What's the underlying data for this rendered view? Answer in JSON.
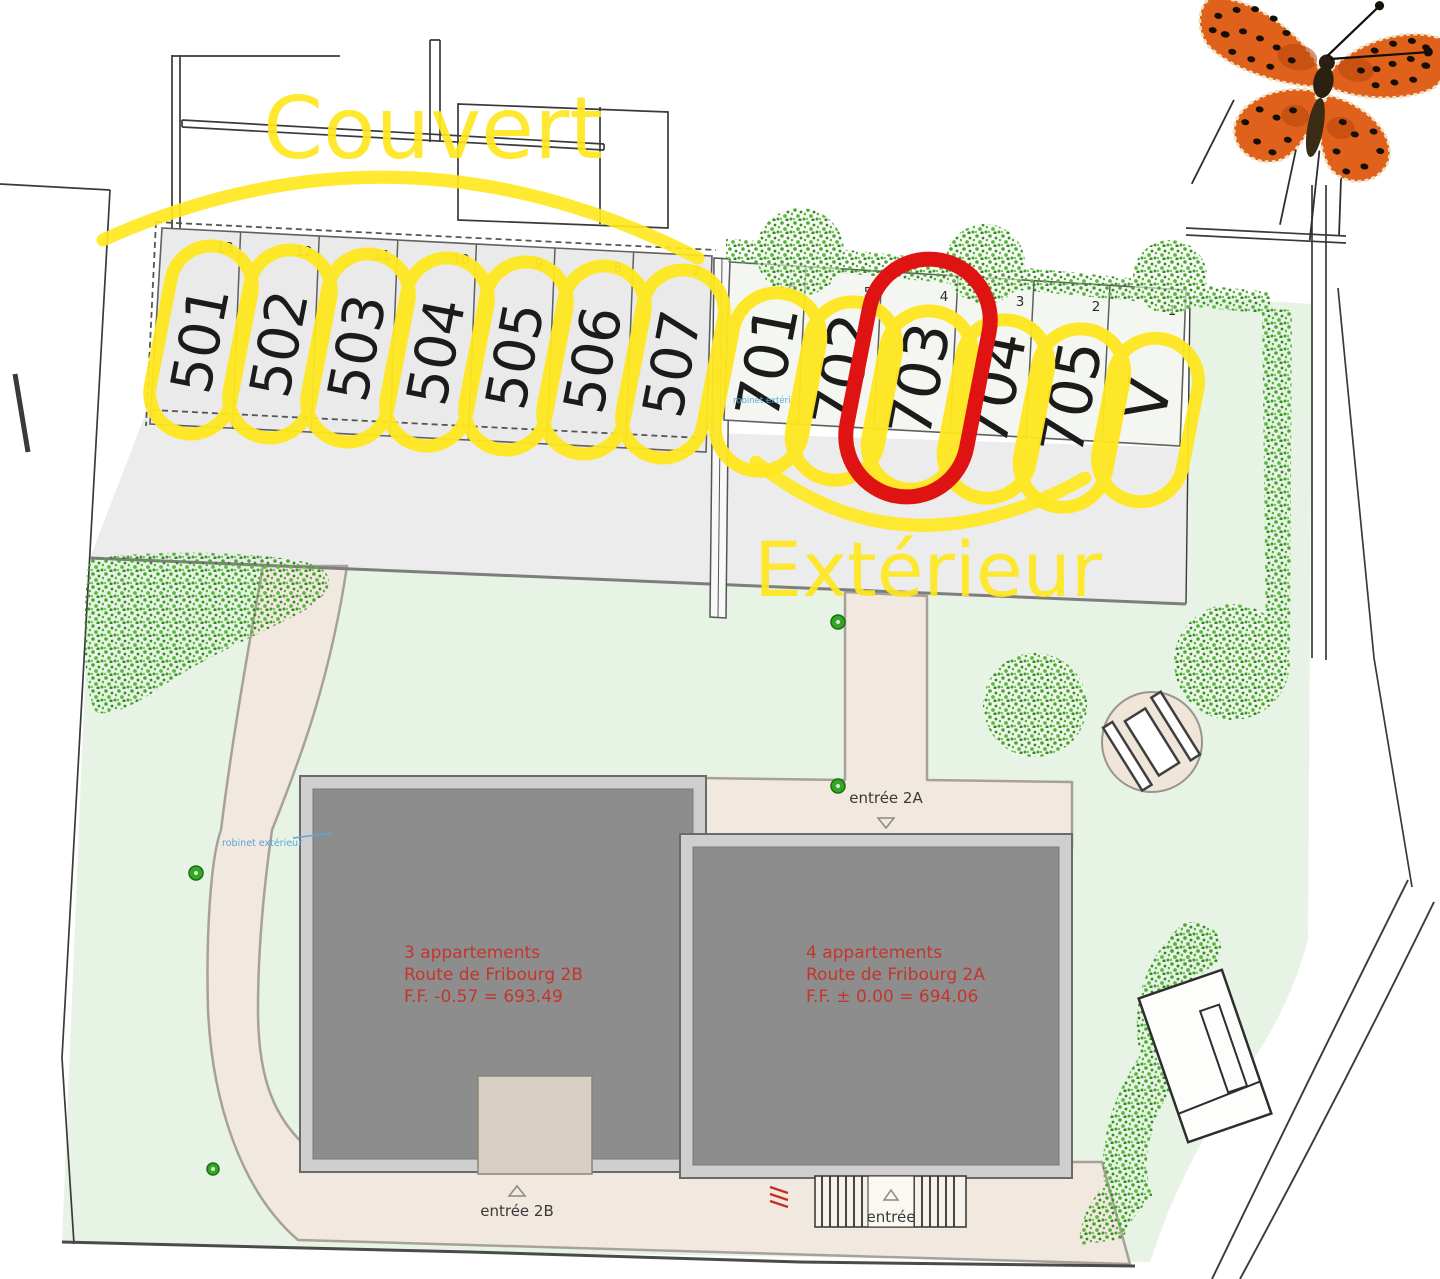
{
  "colors": {
    "annotation_yellow": "#ffe71f",
    "highlight_red": "#e01313",
    "building_text_red": "#c5352c",
    "tap_label_blue": "#5aa7d8"
  },
  "annotations": {
    "covered_zone_label": "Couvert",
    "exterior_zone_label": "Extérieur"
  },
  "parking": {
    "covered_stalls": [
      {
        "label": "501",
        "bay": "13"
      },
      {
        "label": "502",
        "bay": "12"
      },
      {
        "label": "503",
        "bay": "11"
      },
      {
        "label": "504",
        "bay": "10"
      },
      {
        "label": "505",
        "bay": "9"
      },
      {
        "label": "506",
        "bay": "8"
      },
      {
        "label": "507",
        "bay": "7"
      }
    ],
    "exterior_stalls": [
      {
        "label": "701",
        "bay": "6"
      },
      {
        "label": "702",
        "bay": "5"
      },
      {
        "label": "703",
        "bay": "4"
      },
      {
        "label": "704",
        "bay": "3"
      },
      {
        "label": "705",
        "bay": "2"
      },
      {
        "label": "V",
        "bay": "1"
      }
    ]
  },
  "buildings": {
    "building_2b": {
      "line1": "3 appartements",
      "line2": "Route de Fribourg 2B",
      "line3": "F.F. -0.57 = 693.49"
    },
    "building_2a": {
      "line1": "4 appartements",
      "line2": "Route de Fribourg 2A",
      "line3": "F.F. ± 0.00 = 694.06"
    }
  },
  "entrances": {
    "entrance_2a": "entrée 2A",
    "entrance_2b": "entrée 2B",
    "entrance_main": "entrée"
  },
  "utilities": {
    "tap_left": "robinet extérieur",
    "tap_parking": "robinet extérieur"
  }
}
